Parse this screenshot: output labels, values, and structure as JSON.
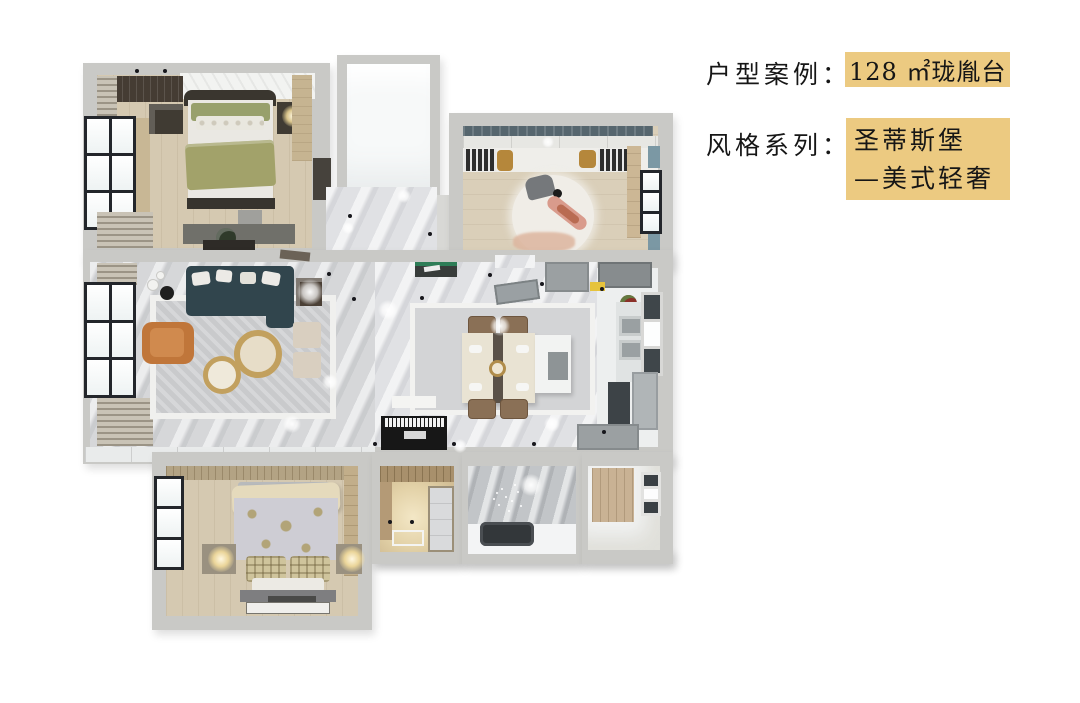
{
  "panel": {
    "line1_label": "户型案例：",
    "line1_value": "128 ㎡珑胤台",
    "line2_label": "风格系列：",
    "line2_value": "圣蒂斯堡",
    "line3_value": "—美式轻奢",
    "highlight_color": "#ecca81",
    "text_color": "#161616"
  },
  "floorplan": {
    "rooms": [
      "master-bedroom",
      "top-bathroom",
      "study-room",
      "entry-corridor",
      "living-room",
      "dining-room",
      "kitchen",
      "second-bedroom",
      "cloakroom",
      "lower-bathroom",
      "utility-room"
    ],
    "colors": {
      "wall": "#c9c9c6",
      "wood_floor": "#d5c9b1",
      "marble_floor": "#dcdde0",
      "sofa_teal": "#31454d",
      "accent_armchair_orange": "#c0763a",
      "bedding_olive": "#a2a26a",
      "bedding_cream": "#e5dabc",
      "gold_table": "#c2a05e",
      "bathtub_dark": "#33373a",
      "console_green": "#2e7d57"
    }
  }
}
